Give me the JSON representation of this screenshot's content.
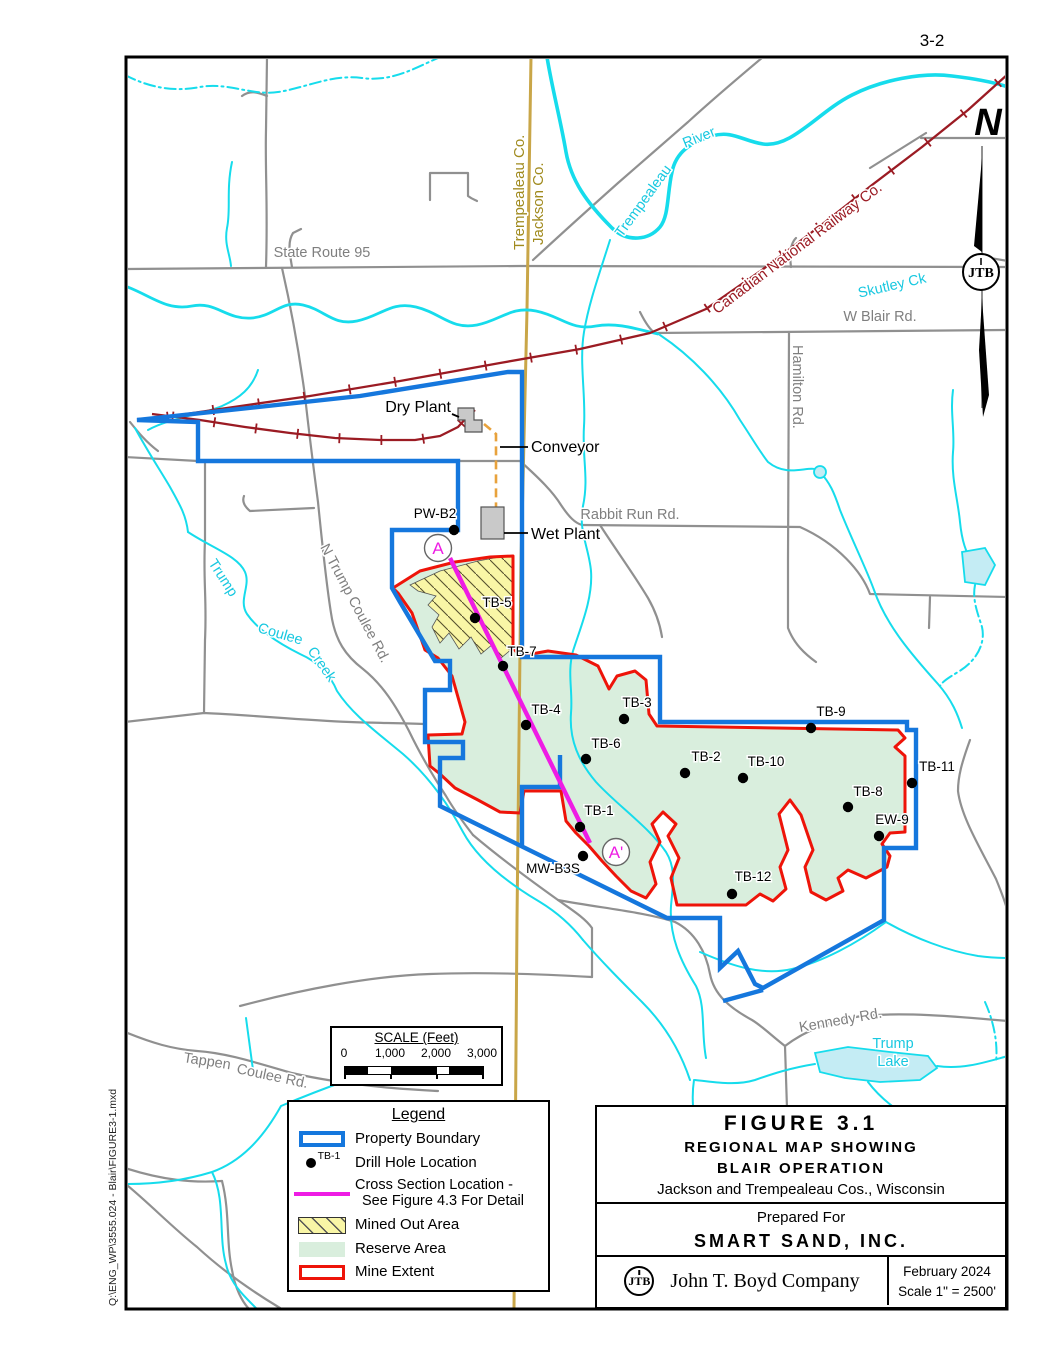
{
  "page": {
    "number": "3-2",
    "file_path": "Q:\\ENG_WP\\3555.024 - Blair\\FIGURE3-1.mxd",
    "north_label": "N",
    "logo_text": "JTB"
  },
  "colors": {
    "property_boundary": "#1577dd",
    "mine_extent": "#ee1409",
    "reserve_fill": "#d9eedd",
    "mined_out_fill": "#f9f6a6",
    "cross_section": "#ee1ce4",
    "stream": "#16dcec",
    "lake_fill": "#c4ecf4",
    "road": "#909090",
    "railway": "#9b1b23",
    "county_line": "#c9a648",
    "county_text": "#a08a1e",
    "building_fill": "#c9c9c9",
    "conveyor": "#e8a23c"
  },
  "map_labels": {
    "state_route": "State Route 95",
    "county_left": "Trempealeau Co.",
    "county_right": "Jackson Co.",
    "river_1": "Trempealeau",
    "river_2": "River",
    "railway": "Canadian National   Railway Co.",
    "skutley": "Skutley Ck",
    "w_blair": "W Blair Rd.",
    "hamilton": "Hamilton Rd.",
    "dry_plant": "Dry Plant",
    "conveyor": "Conveyor",
    "wet_plant": "Wet Plant",
    "rabbit_run": "Rabbit Run Rd.",
    "n_trump_coulee": "N Trump Coulee Rd.",
    "trump": "Trump",
    "coulee": "Coulee",
    "creek": "Creek",
    "tappen_1": "Tappen",
    "tappen_2": "Coulee Rd.",
    "kennedy": "Kennedy Rd.",
    "trump_lake_1": "Trump",
    "trump_lake_2": "Lake",
    "section_start": "A",
    "section_end": "A'"
  },
  "drill_holes": [
    {
      "label": "PW-B2",
      "x": 454,
      "y": 530,
      "lx": 435,
      "ly": 518
    },
    {
      "label": "TB-5",
      "x": 475,
      "y": 618,
      "lx": 497,
      "ly": 607
    },
    {
      "label": "TB-7",
      "x": 503,
      "y": 666,
      "lx": 522,
      "ly": 656
    },
    {
      "label": "TB-4",
      "x": 526,
      "y": 725,
      "lx": 546,
      "ly": 714
    },
    {
      "label": "TB-3",
      "x": 624,
      "y": 719,
      "lx": 637,
      "ly": 707
    },
    {
      "label": "TB-6",
      "x": 586,
      "y": 759,
      "lx": 606,
      "ly": 748
    },
    {
      "label": "TB-2",
      "x": 685,
      "y": 773,
      "lx": 706,
      "ly": 761
    },
    {
      "label": "TB-10",
      "x": 743,
      "y": 778,
      "lx": 766,
      "ly": 766
    },
    {
      "label": "TB-9",
      "x": 811,
      "y": 728,
      "lx": 831,
      "ly": 716
    },
    {
      "label": "TB-11",
      "x": 912,
      "y": 783,
      "lx": 937,
      "ly": 771
    },
    {
      "label": "TB-8",
      "x": 848,
      "y": 807,
      "lx": 868,
      "ly": 796
    },
    {
      "label": "EW-9",
      "x": 879,
      "y": 836,
      "lx": 892,
      "ly": 824
    },
    {
      "label": "TB-1",
      "x": 580,
      "y": 827,
      "lx": 599,
      "ly": 815
    },
    {
      "label": "MW-B3S",
      "x": 583,
      "y": 856,
      "lx": 553,
      "ly": 873
    },
    {
      "label": "TB-12",
      "x": 732,
      "y": 894,
      "lx": 753,
      "ly": 881
    }
  ],
  "scale_bar": {
    "title": "SCALE (Feet)",
    "ticks": [
      "0",
      "1,000",
      "2,000",
      "3,000"
    ]
  },
  "legend": {
    "title": "Legend",
    "items": [
      {
        "type": "property-boundary",
        "label": "Property Boundary"
      },
      {
        "type": "drill-hole",
        "sample": "TB-1",
        "label": "Drill Hole Location"
      },
      {
        "type": "cross-section",
        "label": "Cross Section Location -",
        "label2": "See Figure 4.3 For Detail"
      },
      {
        "type": "mined-out",
        "label": "Mined Out Area"
      },
      {
        "type": "reserve",
        "label": "Reserve Area"
      },
      {
        "type": "mine-extent",
        "label": "Mine Extent"
      }
    ]
  },
  "title_block": {
    "figure": "FIGURE  3.1",
    "line1": "REGIONAL  MAP  SHOWING",
    "line2": "BLAIR  OPERATION",
    "line3": "Jackson and Trempealeau Cos., Wisconsin",
    "prepared_for": "Prepared For",
    "client": "SMART  SAND,  INC.",
    "company": "John T. Boyd Company",
    "date": "February 2024",
    "scale": "Scale 1\" = 2500'"
  }
}
